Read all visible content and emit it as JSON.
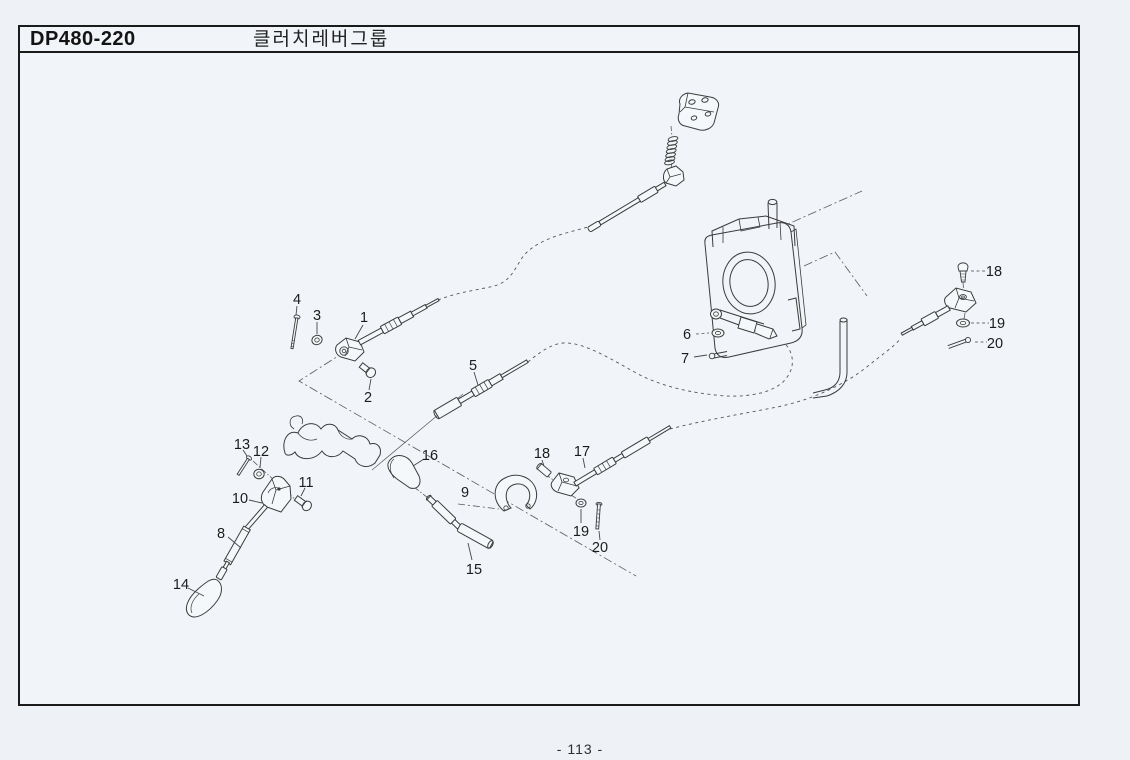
{
  "header": {
    "code": "DP480-220",
    "title": "클러치레버그룹"
  },
  "footer": {
    "page_number": "- 113 -"
  },
  "colors": {
    "ink": "#1b1b1b",
    "line": "#3b3b3b",
    "paper": "#f1f4f8"
  },
  "diagram": {
    "type": "exploded-parts-diagram",
    "description": "Clutch lever group exploded view with numbered part callouts",
    "callouts": [
      {
        "n": "1",
        "x": 364,
        "y": 317
      },
      {
        "n": "2",
        "x": 368,
        "y": 397
      },
      {
        "n": "3",
        "x": 317,
        "y": 315
      },
      {
        "n": "4",
        "x": 297,
        "y": 299
      },
      {
        "n": "5",
        "x": 473,
        "y": 365
      },
      {
        "n": "6",
        "x": 687,
        "y": 334
      },
      {
        "n": "7",
        "x": 685,
        "y": 358
      },
      {
        "n": "8",
        "x": 221,
        "y": 533
      },
      {
        "n": "9",
        "x": 465,
        "y": 492
      },
      {
        "n": "10",
        "x": 240,
        "y": 498
      },
      {
        "n": "11",
        "x": 306,
        "y": 482
      },
      {
        "n": "12",
        "x": 261,
        "y": 451
      },
      {
        "n": "13",
        "x": 242,
        "y": 444
      },
      {
        "n": "14",
        "x": 181,
        "y": 584
      },
      {
        "n": "15",
        "x": 474,
        "y": 569
      },
      {
        "n": "16",
        "x": 430,
        "y": 455
      },
      {
        "n": "17",
        "x": 582,
        "y": 451
      },
      {
        "n": "18",
        "x": 542,
        "y": 453
      },
      {
        "n": "18",
        "x": 994,
        "y": 271
      },
      {
        "n": "19",
        "x": 581,
        "y": 531
      },
      {
        "n": "19",
        "x": 997,
        "y": 323
      },
      {
        "n": "20",
        "x": 600,
        "y": 547
      },
      {
        "n": "20",
        "x": 995,
        "y": 343
      }
    ]
  }
}
